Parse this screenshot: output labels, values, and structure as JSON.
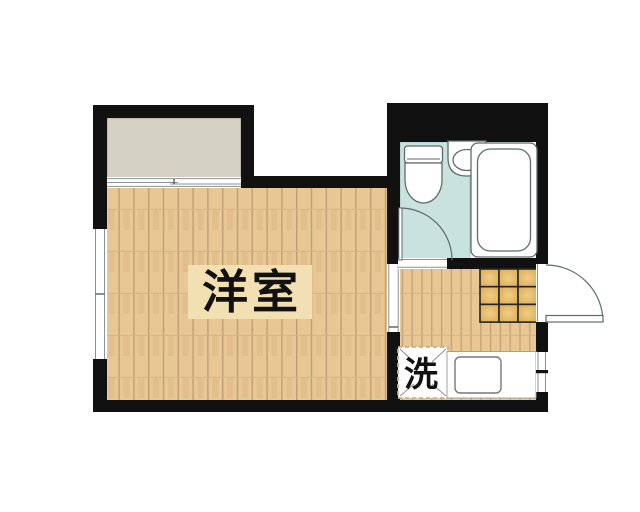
{
  "floorplan": {
    "rooms": {
      "main_room": {
        "label": "洋室"
      },
      "washer": {
        "label": "洗"
      }
    },
    "colors": {
      "background": "#ffffff",
      "wall": "#111111",
      "wood_floor": "#e9c795",
      "wood_plank_line": "#bf9f72",
      "room_label_bg": "#f2dfb2",
      "balcony_gray": "#d5d2c4",
      "bathroom_blue": "#c9e2de",
      "entrance_tile": "#d9a84e",
      "entrance_tile_highlight": "#f0cd85",
      "fixture_outline": "#5f6b6b"
    }
  }
}
